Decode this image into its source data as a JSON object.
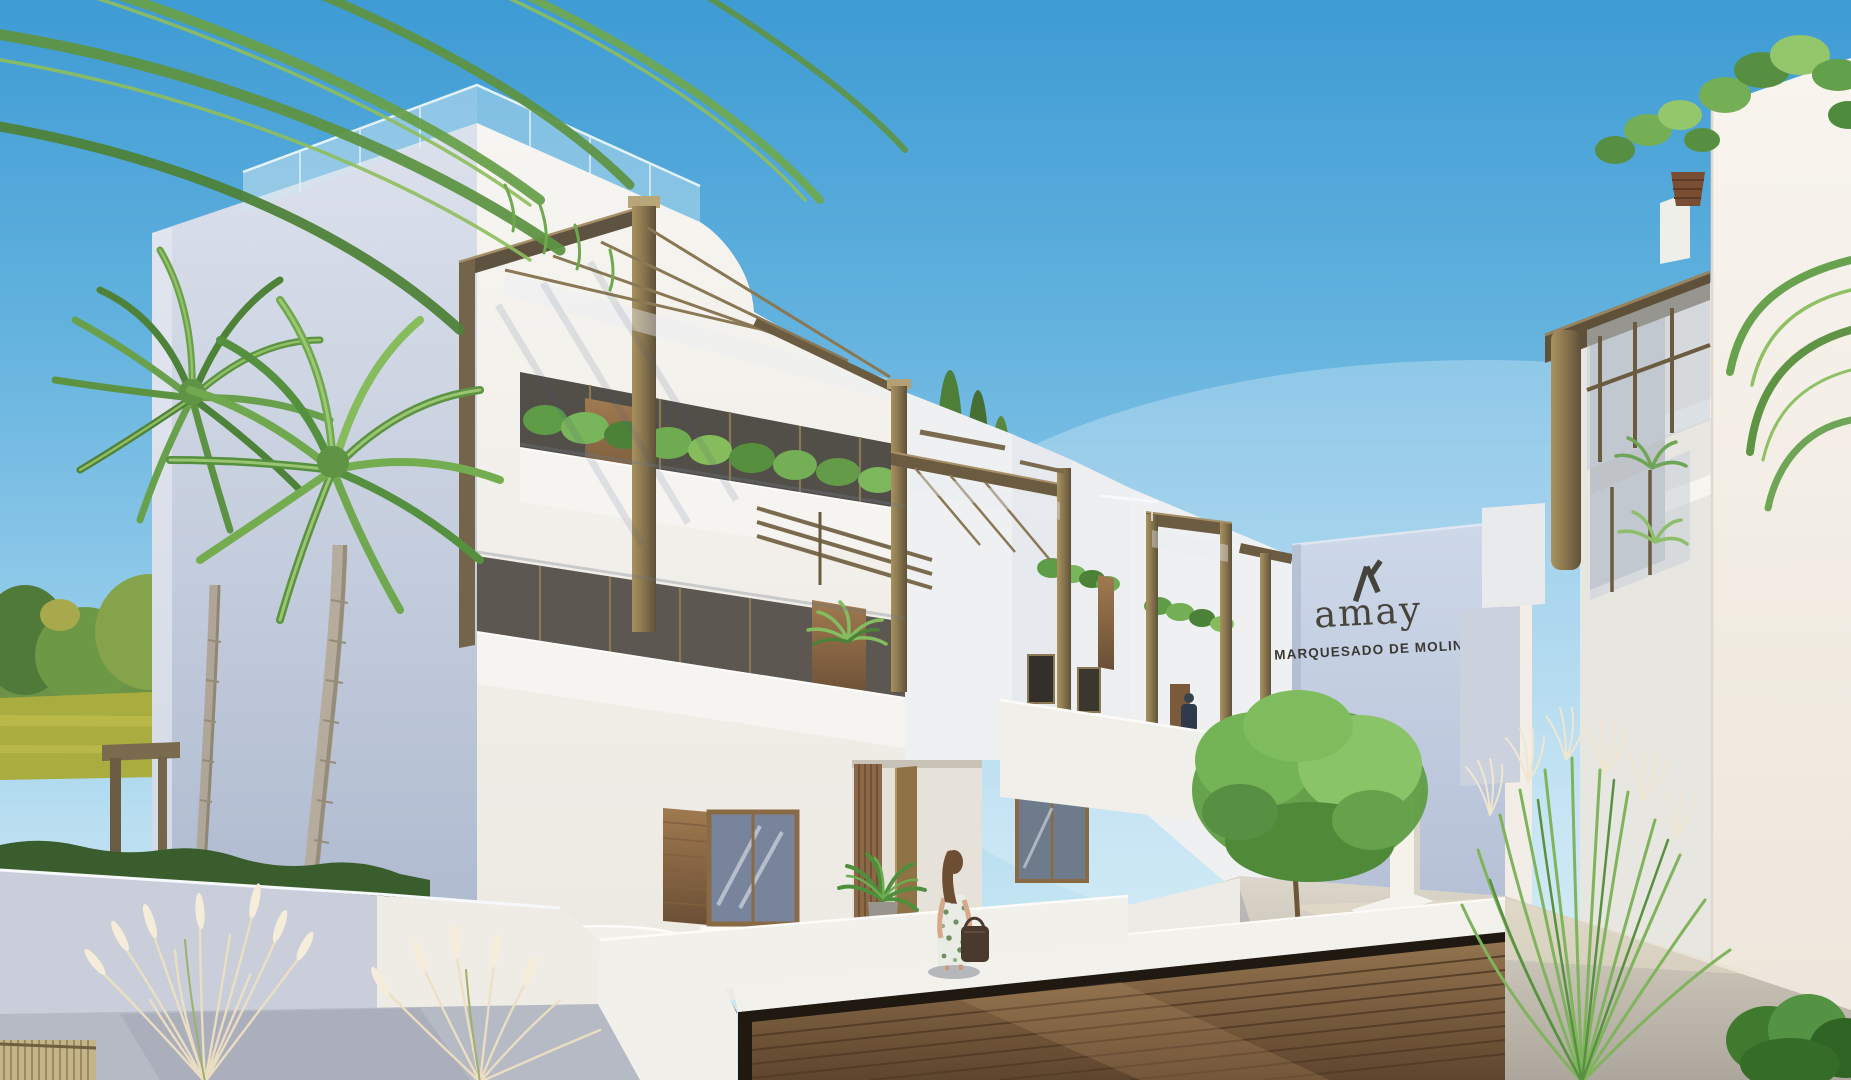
{
  "scene": {
    "description": "Sunny exterior rendering of a modern white three-storey apartment complex with bronze pergolas, roof terraces, palm trees, courtyard garden, basement garage and two people"
  },
  "sign": {
    "brand_logo": "amay",
    "project_name": "MARQUESADO DE MOLINS"
  },
  "palette": {
    "sky_top": "#3e9bd4",
    "sky_horizon": "#d4ecf6",
    "wall_sunlit": "#f5f3ef",
    "wall_shaded": "#b4bfd4",
    "sign_wall": "#c5d0e2",
    "sign_text": "#46433c",
    "pergola_bronze": "#8a7855",
    "wood_accent": "#8a6a45",
    "garage_door_wood": "#8a6b4a",
    "glass_balustrade": "#cfe8f2",
    "grass": "#4e9a31",
    "foliage": "#6fa557",
    "pavement": "#cfc9bd",
    "pampas_plume": "#f5ecda"
  }
}
